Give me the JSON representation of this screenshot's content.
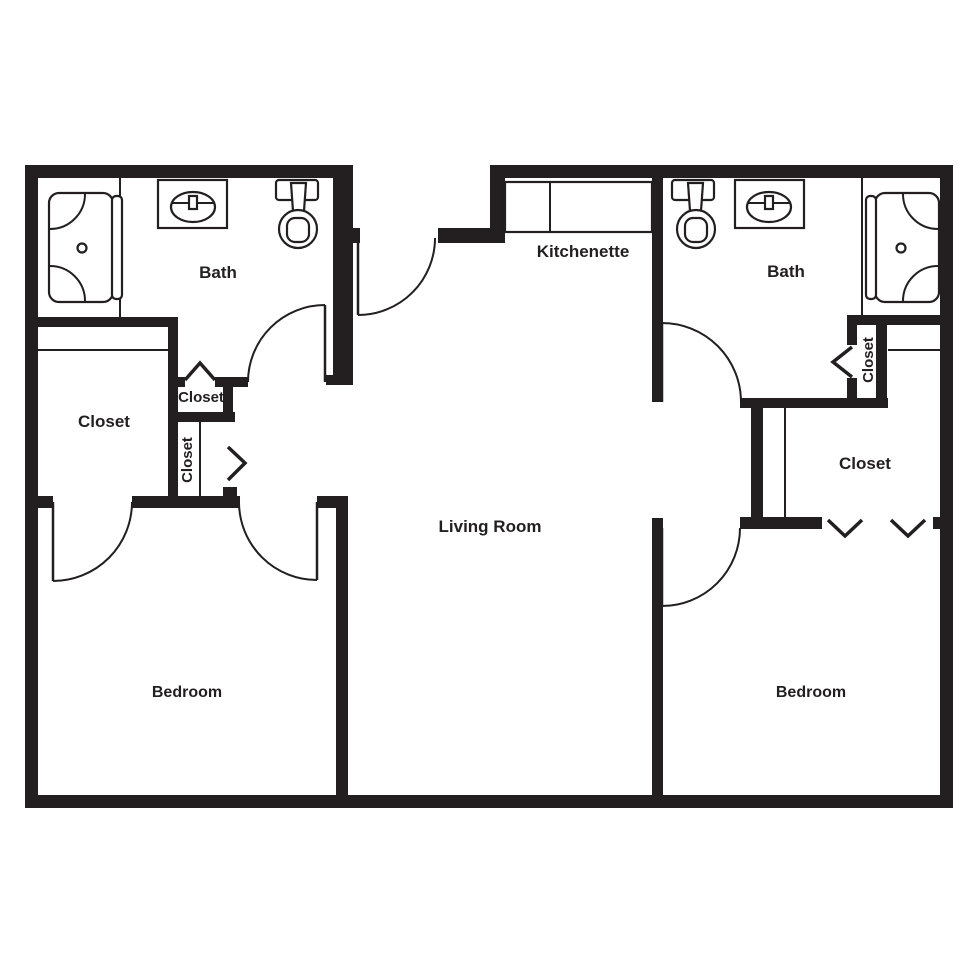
{
  "colors": {
    "ink": "#231f20",
    "background": "#ffffff"
  },
  "rooms": {
    "bath_left": {
      "label": "Bath"
    },
    "kitchenette": {
      "label": "Kitchenette"
    },
    "bath_right": {
      "label": "Bath"
    },
    "closet_left_large": {
      "label": "Closet"
    },
    "closet_left_upper": {
      "label": "Closet"
    },
    "closet_left_lower": {
      "label": "Closet"
    },
    "closet_right_small": {
      "label": "Closet"
    },
    "closet_right_large": {
      "label": "Closet"
    },
    "living_room": {
      "label": "Living Room"
    },
    "bedroom_left": {
      "label": "Bedroom"
    },
    "bedroom_right": {
      "label": "Bedroom"
    }
  }
}
